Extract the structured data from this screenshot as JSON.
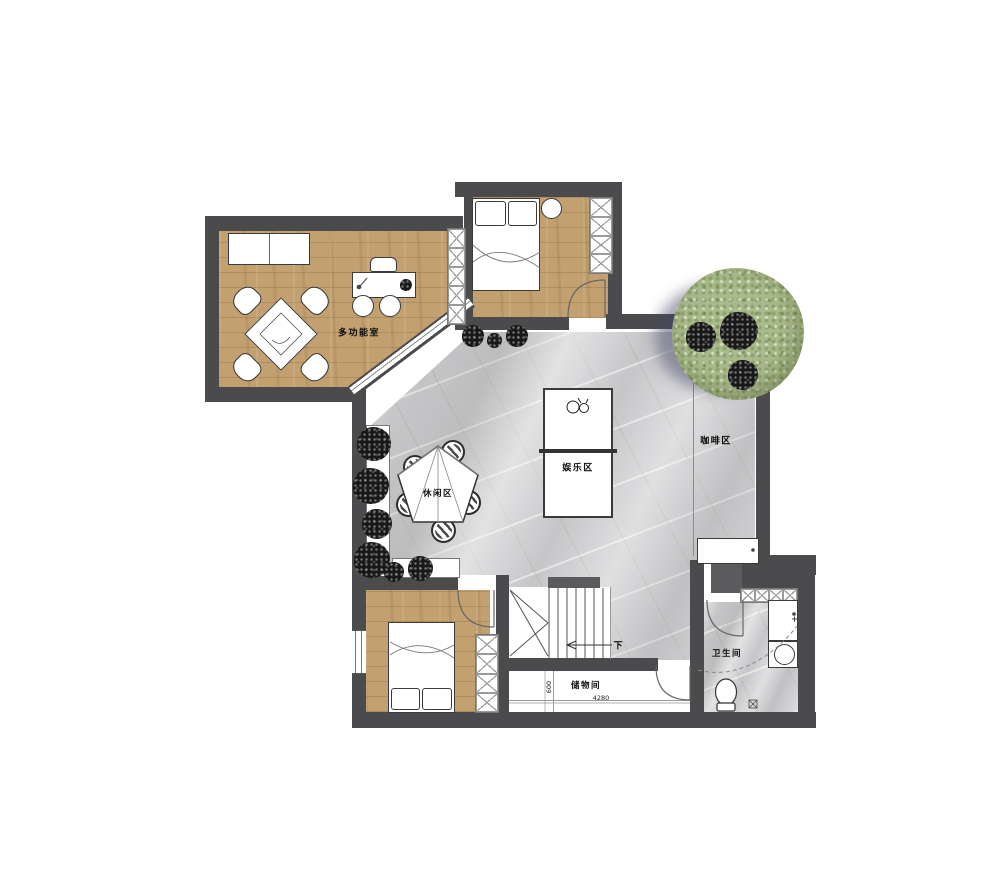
{
  "plan": {
    "rooms": [
      {
        "id": "multi-function-room",
        "label": "多功能室"
      },
      {
        "id": "entertainment-zone",
        "label": "娱乐区"
      },
      {
        "id": "leisure-zone",
        "label": "休闲区"
      },
      {
        "id": "coffee-zone",
        "label": "咖啡区"
      },
      {
        "id": "storage-room",
        "label": "储物间"
      },
      {
        "id": "bathroom",
        "label": "卫生间"
      }
    ],
    "stairs": {
      "down_label": "下"
    },
    "dimensions": {
      "storage_width_mm": "4280",
      "storage_depth_mm": "600"
    },
    "colors": {
      "wall": "#4b4b4e",
      "wood_floor": "#c2a070",
      "marble_floor": "#c6c6c9",
      "tree": "#a9ba8c",
      "plant": "#181818"
    }
  }
}
